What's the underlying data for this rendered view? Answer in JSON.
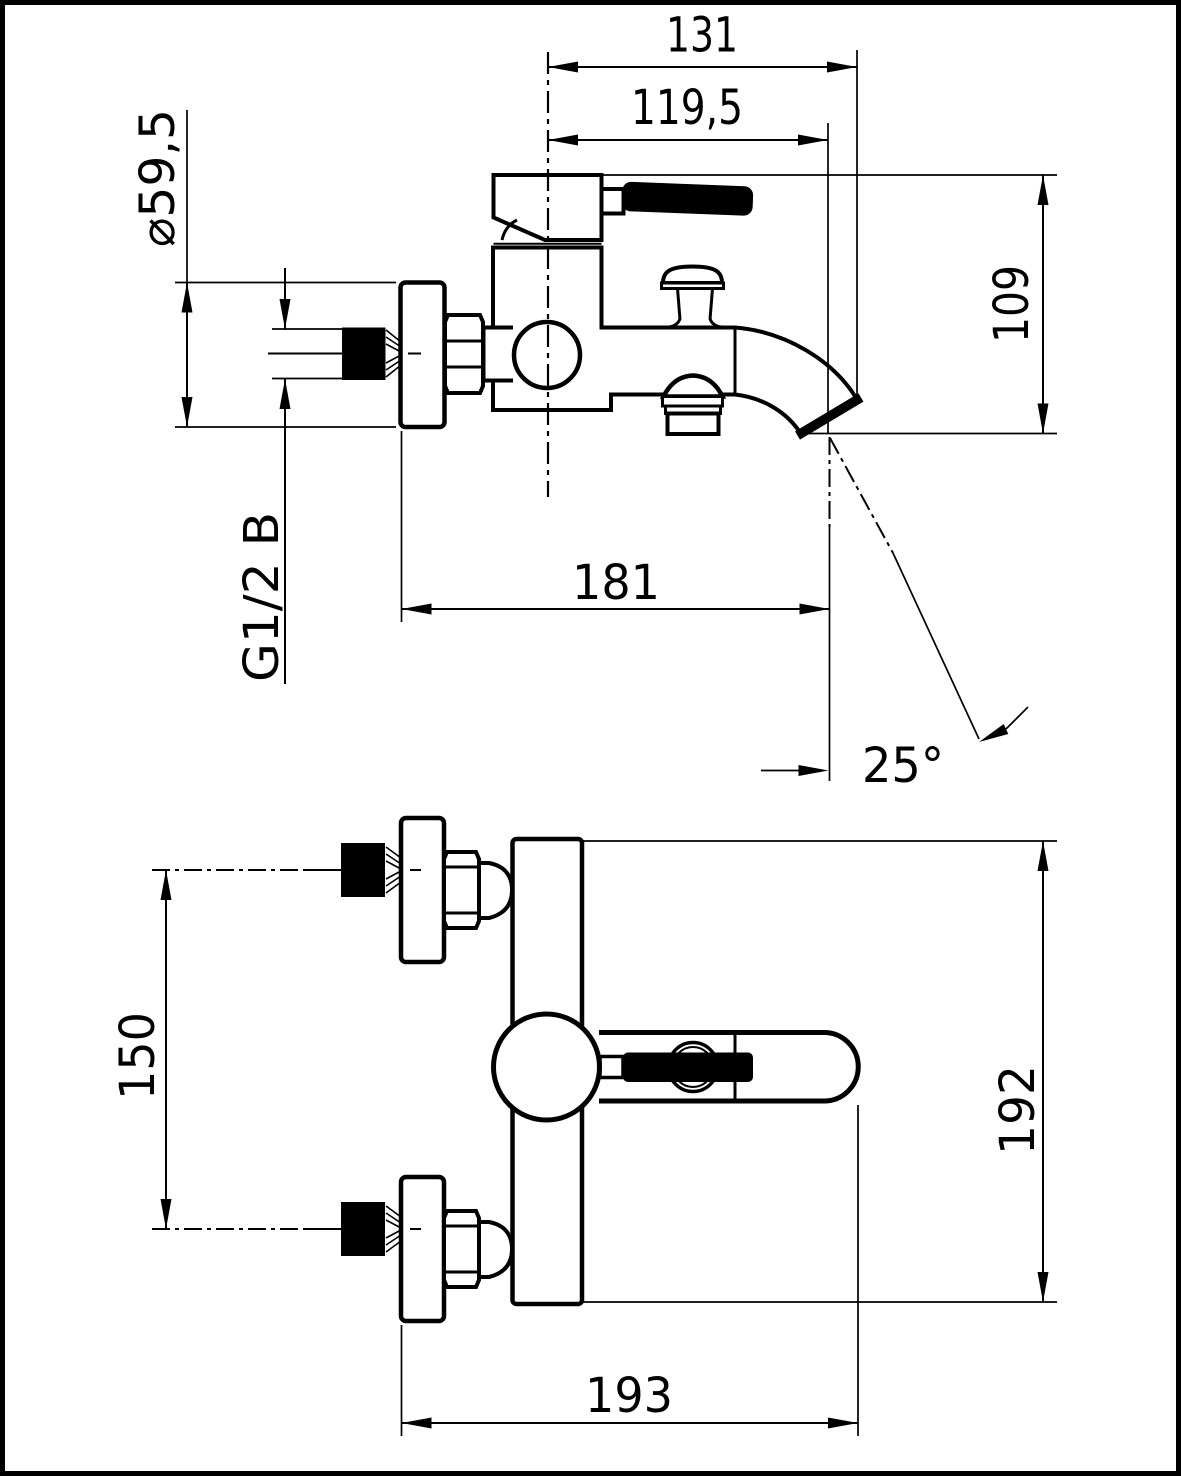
{
  "page": {
    "paper_color": "#ffffff",
    "ink_color": "#000000"
  },
  "diagram": {
    "type": "technical-drawing",
    "subject": "wall-mounted bath mixer tap, dimensioned side and front views",
    "units": "mm",
    "side_view": {
      "total_width": "131",
      "spout_projection": "119,5",
      "flange_diameter": "⌀59,5",
      "height_to_outlet": "109",
      "wall_to_outlet": "181",
      "spout_angle": "25°",
      "thread": "G1/2 B"
    },
    "front_view": {
      "inlet_spacing": "150",
      "overall_height": "192",
      "overall_width": "193"
    }
  }
}
